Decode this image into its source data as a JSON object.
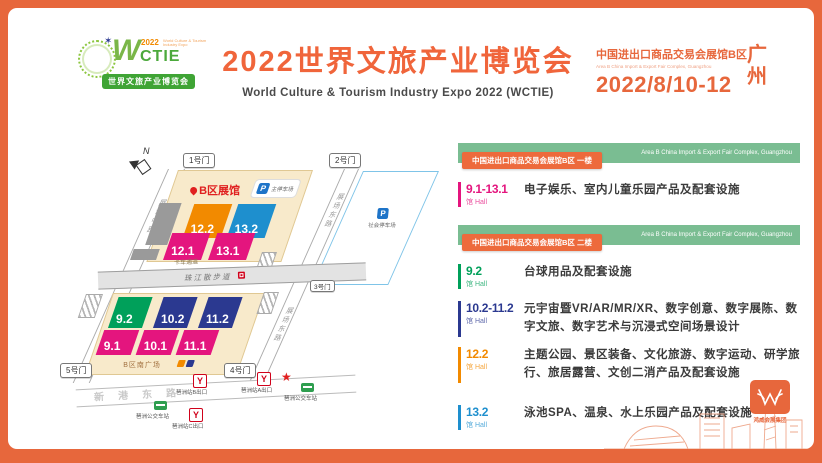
{
  "palette": {
    "accent": "#E7673C",
    "magenta": "#E4157E",
    "orange": "#F28A00",
    "blue": "#1E8FCE",
    "navy": "#2B3990",
    "green": "#00A05A",
    "bar_green": "#7ABD92",
    "badge_orange": "#ED6A3C",
    "beige": "#F8EACB"
  },
  "header": {
    "logo": {
      "w": "W",
      "rest": "CTIE",
      "year": "2022",
      "tagline": "World Culture & Tourism Industry Expo",
      "subtitle": "世界文旅产业博览会",
      "star_glyph": "✶"
    },
    "title": "2022世界文旅产业博览会",
    "subtitle_en": "World Culture & Tourism Industry Expo 2022 (WCTIE)",
    "venue_cn": "中国进出口商品交易会展馆B区",
    "venue_en": "Area B China Import & Export Fair Complex, Guangzhou",
    "date": "2022/8/10-12",
    "city_line1": "广",
    "city_line2": "州"
  },
  "map": {
    "compass": "N",
    "area_label": "B区展馆",
    "gates": {
      "g1": "1号门",
      "g2": "2号门",
      "g3": "3号门",
      "g4": "4号门",
      "g5": "5号门"
    },
    "roads": {
      "west": "展场中路",
      "east": "展场东路",
      "promenade": "珠江散步道",
      "truck": "卡车通道",
      "south": "新港东路"
    },
    "plaza": "B区南广场",
    "parking_small": {
      "p": "P",
      "label": "主停车场"
    },
    "parking_east": {
      "p": "P",
      "label": "社会停车场"
    },
    "halls": {
      "h122": "12.2",
      "h132": "13.2",
      "h121": "12.1",
      "h131": "13.1",
      "h92": "9.2",
      "h102": "10.2",
      "h112": "11.2",
      "h91": "9.1",
      "h101": "10.1",
      "h111": "11.1"
    },
    "transit": {
      "metro_glyph": "Y",
      "metro_a": "琶洲站A出口",
      "metro_b": "琶洲站B出口",
      "metro_c": "琶洲站C出口",
      "bus": "琶洲公交车站",
      "star_glyph": "★"
    }
  },
  "legend": {
    "floor1": {
      "badge": "中国进出口商品交易会展馆B区 一楼",
      "bar_en": "Area B China Import & Export Fair Complex, Guangzhou"
    },
    "floor2": {
      "badge": "中国进出口商品交易会展馆B区 二楼",
      "bar_en": "Area B China Import & Export Fair Complex, Guangzhou"
    },
    "hall_suffix": "馆 Hall",
    "rows": [
      {
        "range": "9.1-13.1",
        "color": "#E4157E",
        "desc": "电子娱乐、室内儿童乐园产品及配套设施"
      },
      {
        "range": "9.2",
        "color": "#00A05A",
        "desc": "台球用品及配套设施"
      },
      {
        "range": "10.2-11.2",
        "color": "#2B3990",
        "desc": "元宇宙暨VR/AR/MR/XR、数字创意、数字展陈、数字文旅、数字艺术与沉浸式空间场景设计"
      },
      {
        "range": "12.2",
        "color": "#F28A00",
        "desc": "主题公园、景区装备、文化旅游、数字运动、研学旅行、旅居露营、文创二消产品及配套设施"
      },
      {
        "range": "13.2",
        "color": "#1E8FCE",
        "desc": "泳池SPA、温泉、水上乐园产品及配套设施"
      }
    ]
  },
  "footer": {
    "group_name": "鸿威会展集团"
  }
}
